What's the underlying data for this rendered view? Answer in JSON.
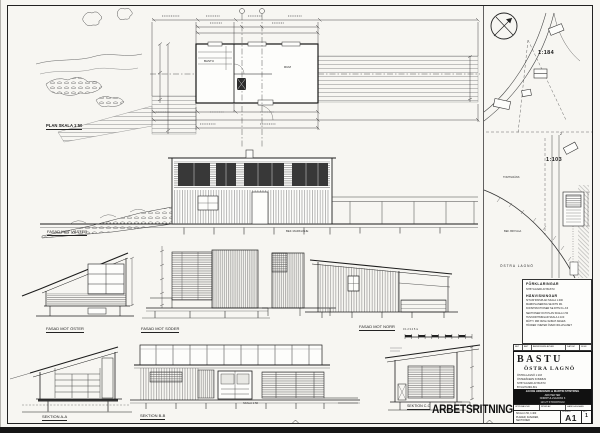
{
  "sheet": {
    "stamp": "ARBETSRITNING"
  },
  "plan": {
    "label": "PLAN  SKALA 1:50",
    "room_left": "BASTU",
    "room_right": "RUM"
  },
  "elevations": {
    "vaster": "FASAD MOT VÄSTER",
    "oster": "FASAD MOT ÖSTER",
    "soder": "FASAD MOT SÖDER",
    "norr": "FASAD MOT NORR",
    "note_marklinje": "BEF. MARKLINJE"
  },
  "sections": {
    "aa": "SEKTION  A-A",
    "bb": "SEKTION  B-B",
    "cc": "SEKTION  C-C",
    "note_skala": "SKALA 1:50"
  },
  "scalebar": {
    "ticks": "0   1   2   3   4   5 m"
  },
  "site": {
    "parcel_upper": "1:184",
    "parcel_lower": "1:103",
    "marker": "2",
    "note_tomtgrans": "TOMTGRÄNS",
    "note_brygga": "BEF. BRYGGA",
    "area": "ÖSTRA LAGNÖ"
  },
  "legend": {
    "title_forklaringar": "FÖRKLARINGAR",
    "forklaring_line": "NYBYGGNAD AV BASTU",
    "title_hanvisningar": "HÄNVISNINGAR",
    "lines": [
      "SITUATIONSPLAN SKALA 1:400",
      "MARKPLANERING SE RITN M1",
      "KONSTRUKTIONER SE RITN K1–K3",
      "SEKTIONER OCH PLAN SKALA 1:50",
      "HUVUDRITNINGAR SKALA 1:100",
      "MÅTT I MM OM EJ ANNAT ANGES",
      "HÖJDER I METER ÖVER NOLLPLANET"
    ],
    "rev_header": {
      "bet": "BET",
      "ant": "ANT",
      "andringen": "ÄNDRINGEN AVSER",
      "datum": "DATUM",
      "sign": "SIGN"
    }
  },
  "titleblock": {
    "project": "BASTU",
    "location": "ÖSTRA LAGNÖ",
    "meta": [
      "ÖSTRA LAGNÖ 1:103",
      "ÖSTERÅKERS KOMMUN",
      "NYBYGGNAD AV BASTU",
      "BYGGHANDLING"
    ],
    "firm": [
      "JACOB HIDEMARK & MARTIN STINTZING",
      "ARKITEKTER",
      "NORRTULLSGATAN 3",
      "113 27 STOCKHOLM"
    ],
    "fields": {
      "uppdrag": "UPPDRAG NR",
      "ritad": "RITAD AV",
      "handlaggare": "HANDLÄGGARE"
    },
    "content": {
      "skala": "SKALA 1:50, 1:400",
      "line1": "PLANER, FASADER,",
      "line2": "SEKTIONER"
    },
    "nummer_label": "NUMMER",
    "bet_label": "BET",
    "drawing_no": "A1",
    "rev": "1"
  },
  "colors": {
    "ink": "#1c1c1c",
    "paper": "#f7f6f2",
    "band": "#111111"
  }
}
